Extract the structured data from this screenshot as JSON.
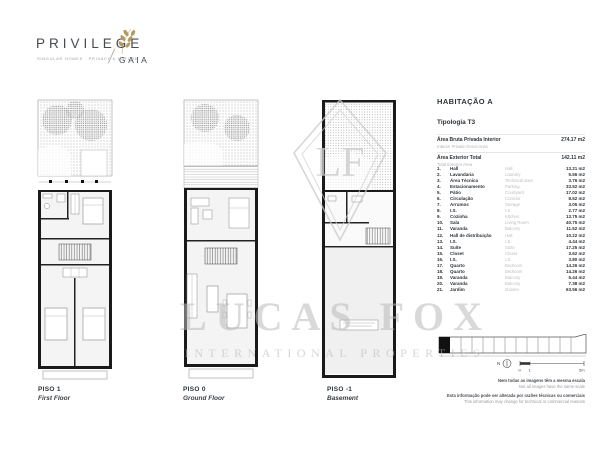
{
  "brand": {
    "name": "PRIVILEGE",
    "tagline": "SINGULAR HOMES · PRIVACY & NATURE",
    "sub": "GAIA",
    "accent_gold": "#b59a5f",
    "ink": "#464b51"
  },
  "unit": {
    "title": "HABITAÇÃO A",
    "typology": "Tipologia T3",
    "summary": [
      {
        "pt": "Área Bruta Privada Interior",
        "en": "Interior Private Gross Area",
        "value": "274.17 m2"
      },
      {
        "pt": "Área Exterior Total",
        "en": "Total Exterior Area",
        "value": "142.11 m2"
      }
    ],
    "rooms": [
      {
        "num": "1.",
        "pt": "Hall",
        "en": "Hall",
        "area": "13.21 m2"
      },
      {
        "num": "2.",
        "pt": "Lavandaria",
        "en": "Laundry",
        "area": "5.56 m2"
      },
      {
        "num": "3.",
        "pt": "Área Técnica",
        "en": "Technical area",
        "area": "3.76 m2"
      },
      {
        "num": "4.",
        "pt": "Estacionamento",
        "en": "Parking",
        "area": "33.52 m2"
      },
      {
        "num": "5.",
        "pt": "Pátio",
        "en": "Courtyard",
        "area": "17.02 m2"
      },
      {
        "num": "6.",
        "pt": "Circulação",
        "en": "Corridor",
        "area": "8.52 m2"
      },
      {
        "num": "7.",
        "pt": "Arrumos",
        "en": "Storage",
        "area": "3.05 m2"
      },
      {
        "num": "8.",
        "pt": "I.S.",
        "en": "I.S.",
        "area": "2.77 m2"
      },
      {
        "num": "9.",
        "pt": "Cozinha",
        "en": "Kitchen",
        "area": "13.75 m2"
      },
      {
        "num": "10.",
        "pt": "Sala",
        "en": "Living Room",
        "area": "40.75 m2"
      },
      {
        "num": "11.",
        "pt": "Varanda",
        "en": "Balcony",
        "area": "11.52 m2"
      },
      {
        "num": "12.",
        "pt": "Hall de distribuição",
        "en": "Hall",
        "area": "10.22 m2"
      },
      {
        "num": "13.",
        "pt": "I.S.",
        "en": "I.S.",
        "area": "4.44 m2"
      },
      {
        "num": "14.",
        "pt": "Suíte",
        "en": "Suite",
        "area": "17.25 m2"
      },
      {
        "num": "15.",
        "pt": "Closet",
        "en": "Closet",
        "area": "3.62 m2"
      },
      {
        "num": "16.",
        "pt": "I.S.",
        "en": "I.S.",
        "area": "3.80 m2"
      },
      {
        "num": "17.",
        "pt": "Quarto",
        "en": "Bedroom",
        "area": "14.26 m2"
      },
      {
        "num": "18.",
        "pt": "Quarto",
        "en": "Bedroom",
        "area": "14.26 m2"
      },
      {
        "num": "19.",
        "pt": "Varanda",
        "en": "Balcony",
        "area": "5.44 m2"
      },
      {
        "num": "20.",
        "pt": "Varanda",
        "en": "Balcony",
        "area": "7.38 m2"
      },
      {
        "num": "21.",
        "pt": "Jardim",
        "en": "Garden",
        "area": "63.56 m2"
      }
    ]
  },
  "floors": [
    {
      "label": "PISO 1",
      "name_en": "First Floor"
    },
    {
      "label": "PISO 0",
      "name_en": "Ground Floor"
    },
    {
      "label": "PISO -1",
      "name_en": "Basement"
    }
  ],
  "map": {
    "north_label": "N",
    "scale_ticks": [
      "0",
      "1",
      "5m"
    ]
  },
  "notes": [
    {
      "pt": "Nem todas as imagens têm a mesma escala",
      "en": "Not all images have the same scale"
    },
    {
      "pt": "Esta informação pode ser alterada por razões técnicas ou comerciais",
      "en": "This information may change for technical or commercial reasons"
    }
  ],
  "watermark": {
    "title": "LUCAS FOX",
    "subtitle": "INTERNATIONAL PROPERTIES",
    "monogram": "LF"
  }
}
